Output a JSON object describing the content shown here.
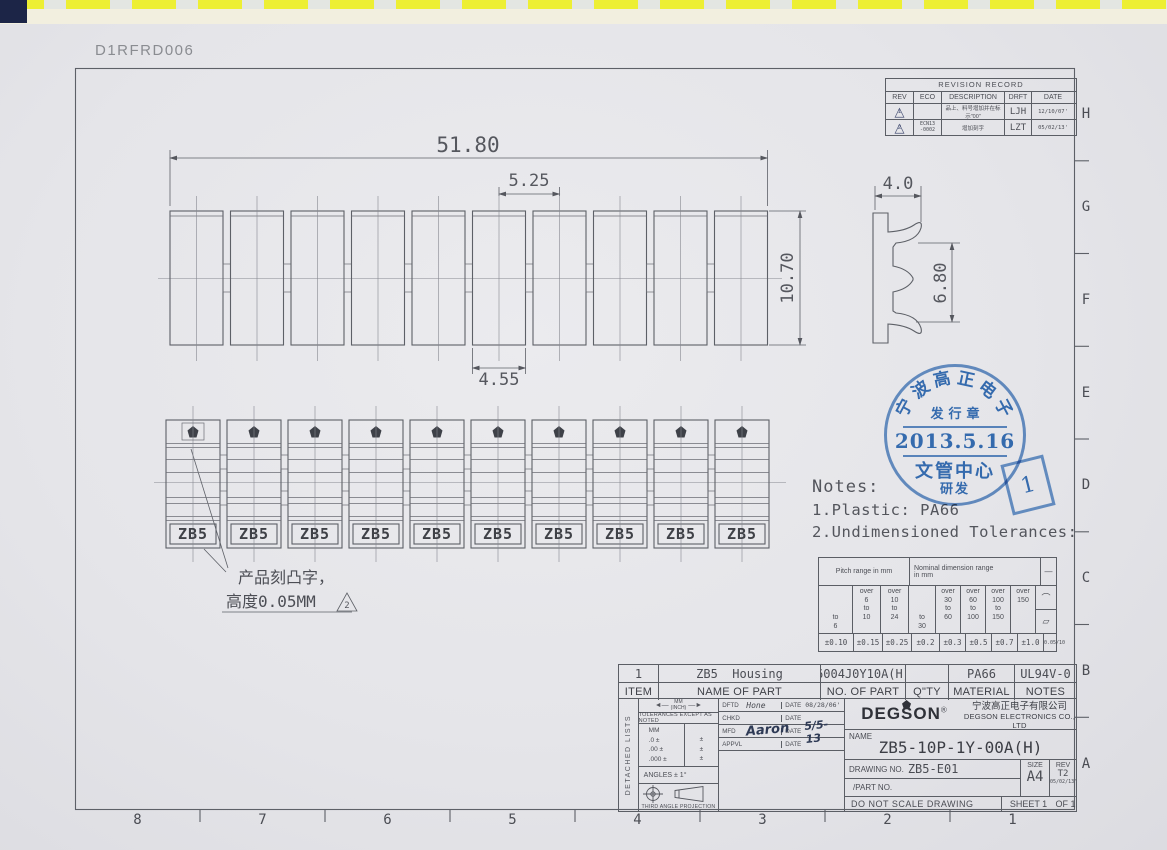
{
  "page": {
    "doc_code": "D1RFRD006"
  },
  "grid": {
    "row_labels": [
      "H",
      "G",
      "F",
      "E",
      "D",
      "C",
      "B",
      "A"
    ],
    "col_labels": [
      "8",
      "7",
      "6",
      "5",
      "4",
      "3",
      "2",
      "1"
    ]
  },
  "revision_record": {
    "title": "REVISION RECORD",
    "headers": {
      "rev": "REV",
      "eco": "ECO",
      "description": "DESCRIPTION",
      "drft": "DRFT",
      "date": "DATE"
    },
    "rows": [
      {
        "rev_mark": "1",
        "eco": "",
        "description": "品上、料号增加并在标示\"00\"",
        "drft": "LJH",
        "date": "12/10/07'"
      },
      {
        "rev_mark": "2",
        "eco": "ECN13\n-0002",
        "description": "增加刻字",
        "drft": "LZT",
        "date": "05/02/13'"
      }
    ]
  },
  "top_view": {
    "dim_overall": "51.80",
    "dim_pitch": "5.25",
    "dim_slot": "4.55",
    "dim_height": "10.70"
  },
  "side_view": {
    "dim_width": "4.0",
    "dim_height": "6.80"
  },
  "front_view": {
    "labels": [
      "ZB5",
      "ZB5",
      "ZB5",
      "ZB5",
      "ZB5",
      "ZB5",
      "ZB5",
      "ZB5",
      "ZB5",
      "ZB5"
    ]
  },
  "engrave_note": {
    "line1": "产品刻凸字，",
    "line2": "高度0.05MM",
    "rev_mark": "2"
  },
  "notes": {
    "title": "Notes:",
    "item1": "1.Plastic: PA66",
    "item2": "2.Undimensioned Tolerances:"
  },
  "tolerance_table": {
    "pitch_header": "Pitch range in mm",
    "nominal_header": "Nominal dimension range\nin mm",
    "ranges": [
      "to\n6",
      "over\n6\nto\n10",
      "over\n10\nto\n24",
      "to\n30",
      "over\n30\nto\n60",
      "over\n60\nto\n100",
      "over\n100\nto\n150",
      "over\n150"
    ],
    "values": [
      "±0.10",
      "±0.15",
      "±0.25",
      "±0.2",
      "±0.3",
      "±0.5",
      "±0.7",
      "±1.0"
    ],
    "symbols": {
      "straightness": "—",
      "arc": "⌒",
      "flatness": "▱",
      "value": "0.05/10"
    }
  },
  "stamp": {
    "arc_chars": [
      "宁",
      "波",
      "高",
      "正",
      "电",
      "子"
    ],
    "issue": "发行章",
    "date": "2013.5.16",
    "center": "文管中心",
    "dept": "研发",
    "page_no": "1",
    "color": "#3a76be"
  },
  "parts_list": {
    "headers": [
      "ITEM",
      "NAME OF PART",
      "NO. OF PART",
      "Q\"TY",
      "MATERIAL",
      "NOTES"
    ],
    "rows": [
      [
        "1",
        "ZB5  Housing",
        "6004J0Y10A(H)",
        "",
        "PA66",
        "UL94V-0"
      ]
    ]
  },
  "title_block": {
    "detached": "DETACHED LISTS",
    "units_mm": "MM",
    "units_inch": "(INCH)",
    "tol_note": "TOLERANCES EXCEPT AS NOTED",
    "tol_rows": "MM\n.0 ±\n.00 ±\n.000 ±",
    "tol_pm": "±\n±\n±",
    "angles": "ANGLES ± 1°",
    "projection": "THIRD ANGLE PROJECTION",
    "sign_rows": [
      {
        "label": "DFTD",
        "value": "Hone",
        "date_label": "DATE",
        "date": "08/28/06'"
      },
      {
        "label": "CHKD",
        "value": "",
        "date_label": "DATE",
        "date": ""
      },
      {
        "label": "MFD",
        "value": "Aaron",
        "date_label": "DATE",
        "date": "5/5-13"
      },
      {
        "label": "APPVL",
        "value": "",
        "date_label": "DATE",
        "date": ""
      }
    ],
    "material": "MATERIAL :",
    "ge": "G.E :",
    "finish": "FINISH:",
    "scale": "SCALE : 1:1",
    "brand": "DEGSON",
    "brand_reg": "®",
    "company_cn": "宁波高正电子有限公司",
    "company_en": "DEGSON ELECTRONICS CO., LTD",
    "name_label": "NAME",
    "part_name": "ZB5-10P-1Y-00A(H)",
    "drawing_no_label": "DRAWING NO.",
    "drawing_no": "ZB5-E01",
    "part_no_label": "/PART  NO.",
    "size_label": "SIZE",
    "size": "A4",
    "rev_label": "REV",
    "rev": "T2",
    "rev_date": "05/02/13'",
    "no_scale": "DO NOT SCALE DRAWING",
    "sheet": "SHEET 1",
    "of": "OF 1"
  }
}
